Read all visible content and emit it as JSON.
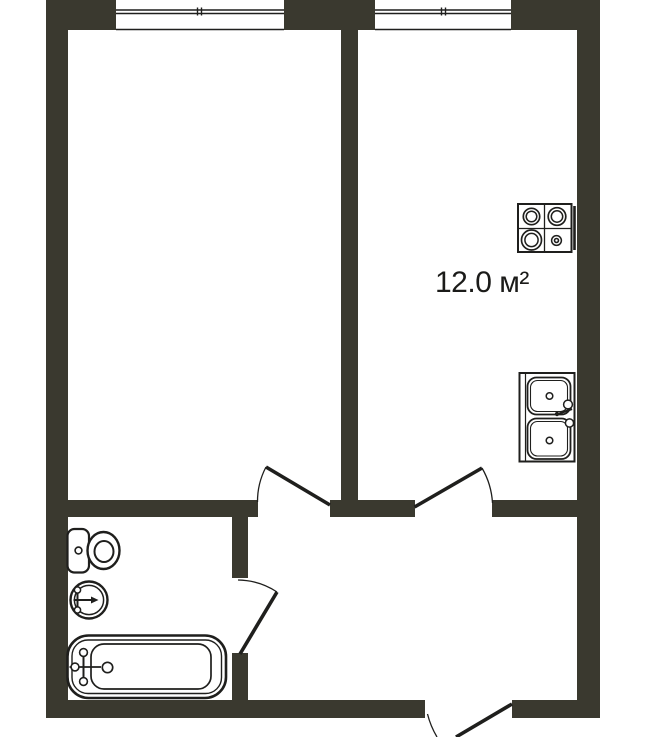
{
  "colors": {
    "wall": "#3a392f",
    "line": "#1f1f1d",
    "bg": "#ffffff",
    "text": "#1b1b19"
  },
  "labels": {
    "kitchen_area": "12.0 м²"
  },
  "icons": {
    "stove": "stove-icon",
    "kitchen_sink": "kitchen-sink-icon",
    "toilet": "toilet-icon",
    "washbasin": "washbasin-icon",
    "bathtub": "bathtub-icon"
  }
}
